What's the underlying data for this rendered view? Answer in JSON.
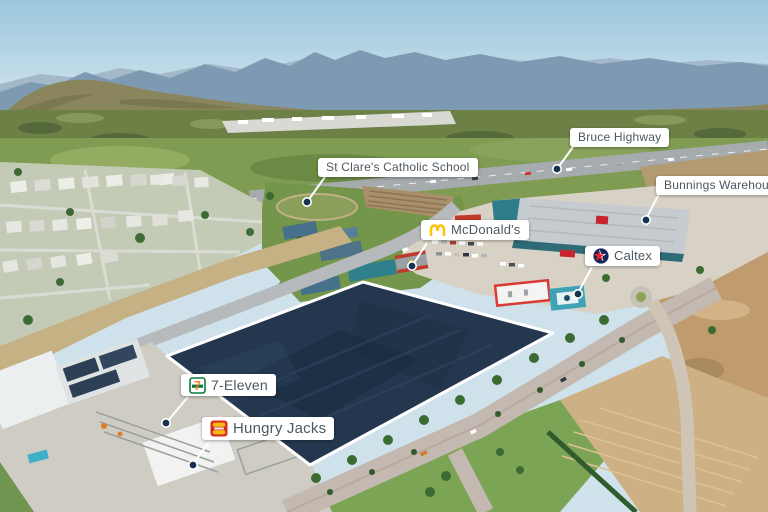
{
  "scene": {
    "type": "aerial-development-site-photo",
    "site_highlight": "large quadrilateral development parcel highlighted navy with white border"
  },
  "labels": {
    "bruce_highway": "Bruce Highway",
    "st_clares": "St Clare's Catholic School",
    "bunnings": "Bunnings Warehouse",
    "mcdonalds": "McDonald's",
    "caltex": "Caltex",
    "seven_eleven": "7-Eleven",
    "hungry_jacks": "Hungry Jacks"
  },
  "colors": {
    "site_fill": "#24374e",
    "site_border": "#ffffff",
    "label_bg": "#ffffff",
    "label_text": "#4b5761",
    "pointer_dot": "#16324f",
    "pointer_line": "#ffffff",
    "mcdonalds_yellow": "#ffc20e",
    "caltex_red": "#e8252a",
    "caltex_navy": "#15265c",
    "seven_eleven_green": "#0b7a3e",
    "seven_eleven_orange": "#f58426",
    "hungry_jacks_red": "#d62b1f",
    "hungry_jacks_yellow": "#fbb817"
  }
}
